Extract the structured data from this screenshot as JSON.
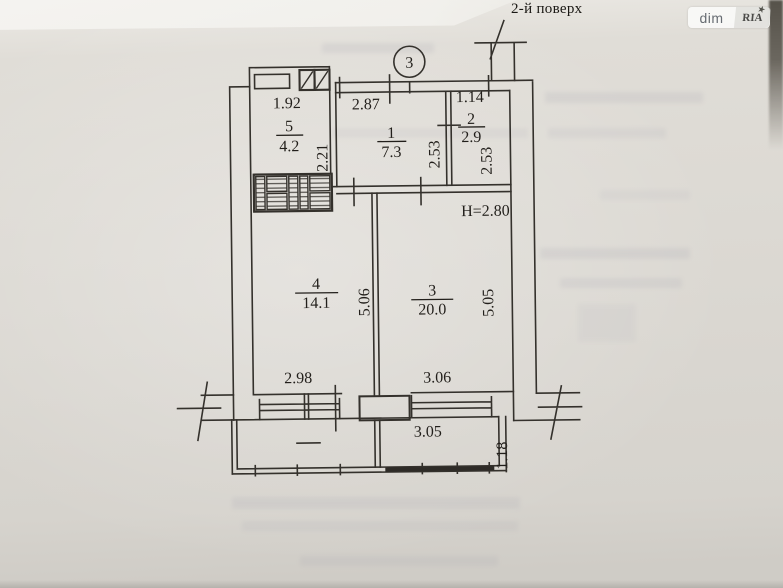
{
  "page": {
    "floor_label": "2-й поверх",
    "watermark_left": "dim",
    "watermark_right": "RIA",
    "watermark_star": "★",
    "axis_number": "3",
    "ceiling_height": "H=2.80"
  },
  "rooms": {
    "r1": {
      "number": "1",
      "area": "7.3"
    },
    "r2": {
      "number": "2",
      "area": "2.9"
    },
    "r3": {
      "number": "3",
      "area": "20.0"
    },
    "r4": {
      "number": "4",
      "area": "14.1"
    },
    "r5": {
      "number": "5",
      "area": "4.2"
    }
  },
  "dims": {
    "room5_width": "1.92",
    "hall_width": "2.87",
    "wc_width": "1.14",
    "room5_depth": "2.21",
    "hall_depth": "2.53",
    "wc_depth": "2.53",
    "room4_depth": "5.06",
    "room3_depth": "5.05",
    "room4_width": "2.98",
    "room3_width": "3.06",
    "balcony_width": "3.05",
    "balcony_depth": "1.18"
  }
}
